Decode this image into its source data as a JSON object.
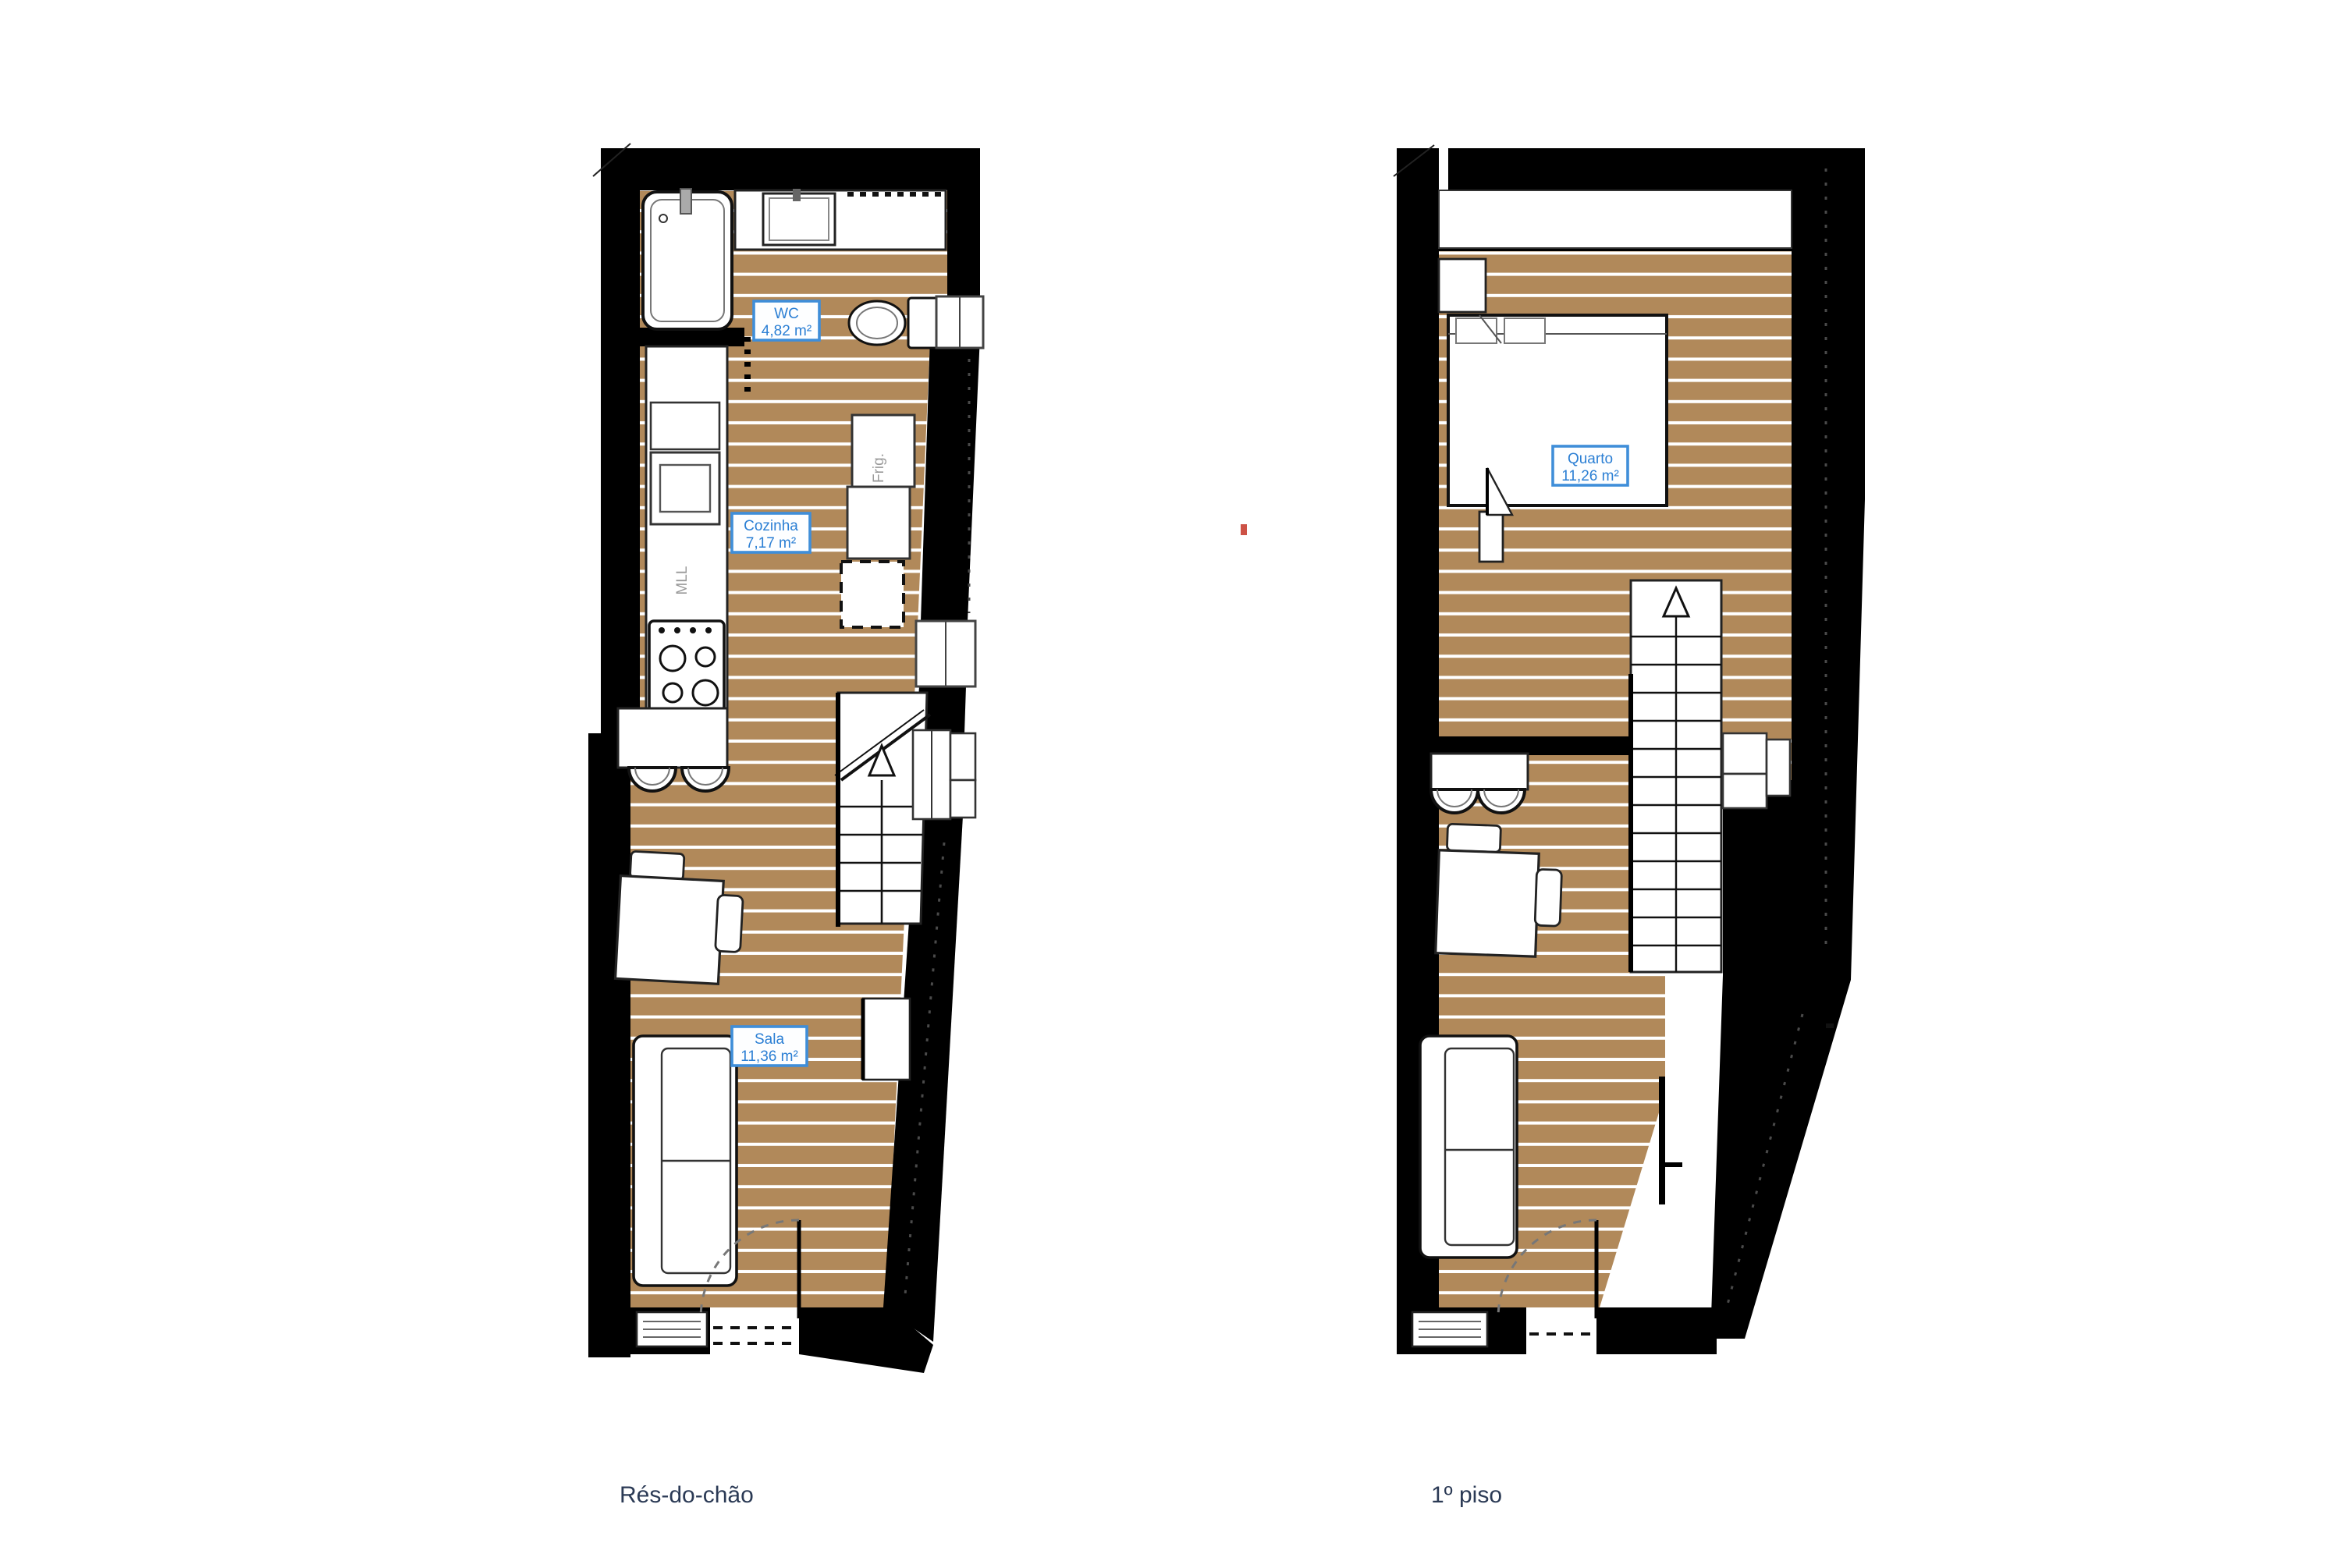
{
  "page": {
    "background": "#ffffff"
  },
  "colors": {
    "wall": "#000000",
    "wood": "#b1895a",
    "plank_line": "#ffffff",
    "label_text": "#2b7fd4",
    "label_border": "#3f8ed9",
    "label_bg": "#fdfeff",
    "caption_text": "#2b3a55",
    "fixture_outline": "#1a1a1a",
    "accent_mark": "#cd5246"
  },
  "ground_floor": {
    "caption": "Rés-do-chão",
    "rooms": [
      {
        "name": "WC",
        "area": "4,82 m²"
      },
      {
        "name": "Cozinha",
        "area": "7,17 m²"
      },
      {
        "name": "Sala",
        "area": "11,36 m²"
      }
    ],
    "fixtures": {
      "dishwasher_label": "MLL",
      "fridge_label": "Frig."
    }
  },
  "first_floor": {
    "caption": "1º piso",
    "rooms": [
      {
        "name": "Quarto",
        "area": "11,26 m²"
      }
    ]
  }
}
